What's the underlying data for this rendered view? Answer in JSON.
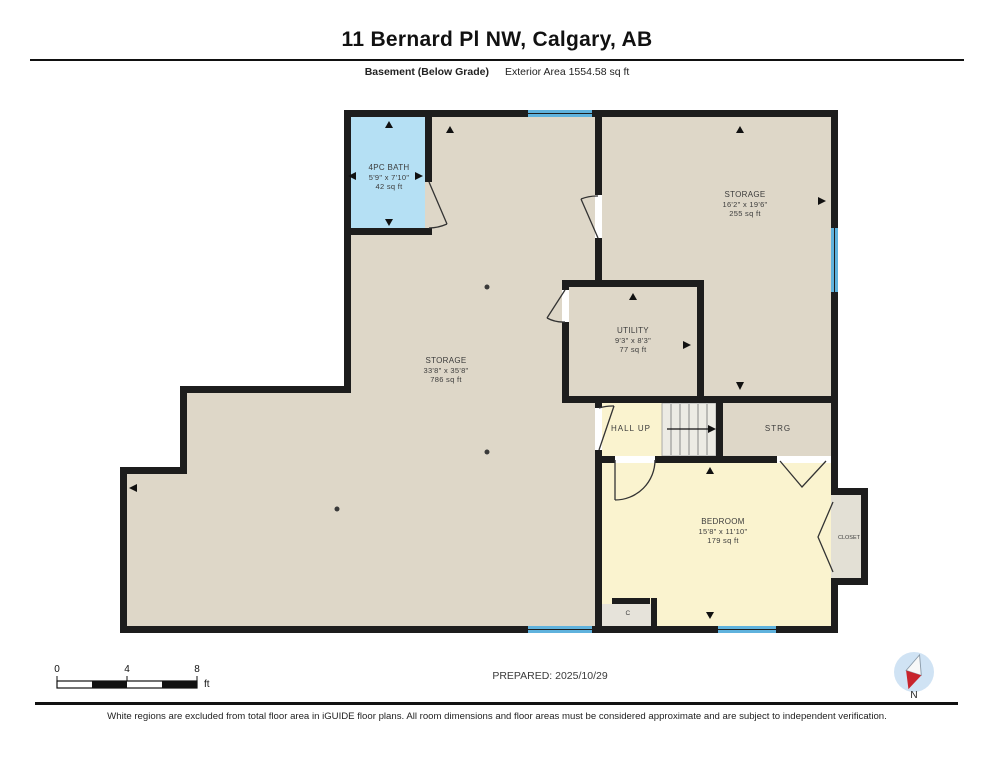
{
  "header": {
    "title": "11 Bernard Pl NW, Calgary, AB",
    "floor_label": "Basement (Below Grade)",
    "area_label": "Exterior Area 1554.58 sq ft"
  },
  "rooms": {
    "bath": {
      "name": "4PC BATH",
      "dims": "5'9\" x 7'10\"",
      "area": "42 sq ft"
    },
    "storage_right": {
      "name": "STORAGE",
      "dims": "16'2\" x 19'6\"",
      "area": "255 sq ft"
    },
    "utility": {
      "name": "UTILITY",
      "dims": "9'3\" x 8'3\"",
      "area": "77 sq ft"
    },
    "storage_main": {
      "name": "STORAGE",
      "dims": "33'8\" x 35'8\"",
      "area": "786 sq ft"
    },
    "hall": {
      "name": "HALL UP"
    },
    "strg": {
      "name": "STRG"
    },
    "bedroom": {
      "name": "BEDROOM",
      "dims": "15'8\" x 11'10\"",
      "area": "179 sq ft"
    },
    "closet": {
      "name": "CLOSET"
    },
    "closet_c": {
      "name": "C"
    }
  },
  "scale_bar": {
    "tick0": "0",
    "tick4": "4",
    "tick8": "8",
    "unit": "ft"
  },
  "prepared_label": "PREPARED: 2025/10/29",
  "compass": {
    "label": "N"
  },
  "footer_note": "White regions are excluded from total floor area in iGUIDE floor plans. All room dimensions and floor areas must be considered approximate and are subject to independent verification.",
  "colors": {
    "wall": "#1d1d1d",
    "room_beige": "#ded7c8",
    "room_yellow": "#faf3cf",
    "room_blue": "#b5e0f4",
    "window_blue": "#5fb2dd",
    "stairs_grey": "#ecebe4",
    "closet_grey": "#e3e0d5",
    "compass_circle": "#d0e3f4",
    "compass_red": "#c8242c"
  }
}
